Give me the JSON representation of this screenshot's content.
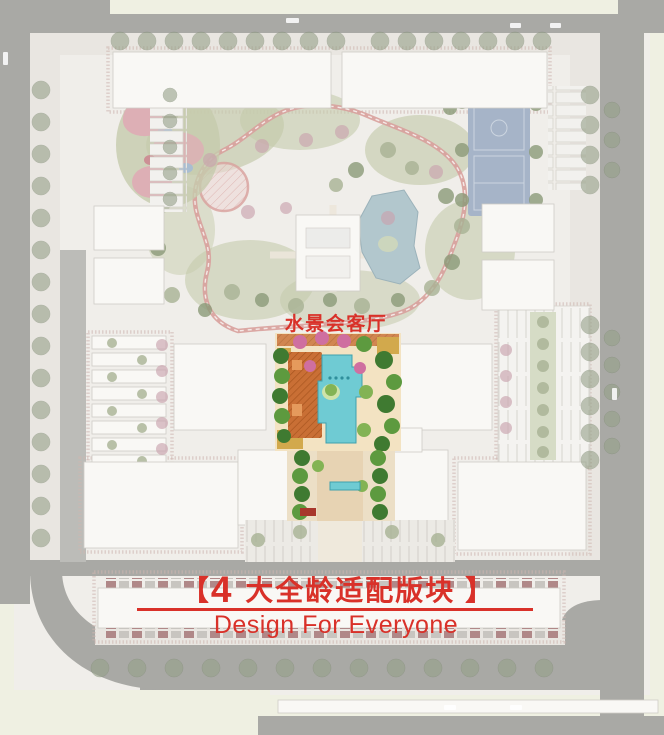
{
  "annotations": {
    "water_feature_label": {
      "text": "水景会客厅"
    },
    "section_title": {
      "bracket_left": "【",
      "number": "4",
      "title": "大全龄适配版块",
      "bracket_right": "】"
    },
    "subtitle": {
      "text": "Design For Everyone"
    }
  },
  "colors": {
    "annotation_red": "#d93129",
    "road_gray": "#a9a9a5",
    "outer_cream": "#eff0e2",
    "site_base": "#f0eeea",
    "building_fill": "#f9f8f5",
    "muted_green": "#c5cbac",
    "path_pink": "#d8a09c",
    "pond_blue": "#b2c7cd",
    "court_blue": "#a6b4c8",
    "playground_pink": "#ddafb5",
    "pool_cyan": "#6fcbd3",
    "plaza_orange": "#c96f35",
    "vivid_green": "#5d9a3f",
    "lawn_gold": "#d2a94c"
  }
}
